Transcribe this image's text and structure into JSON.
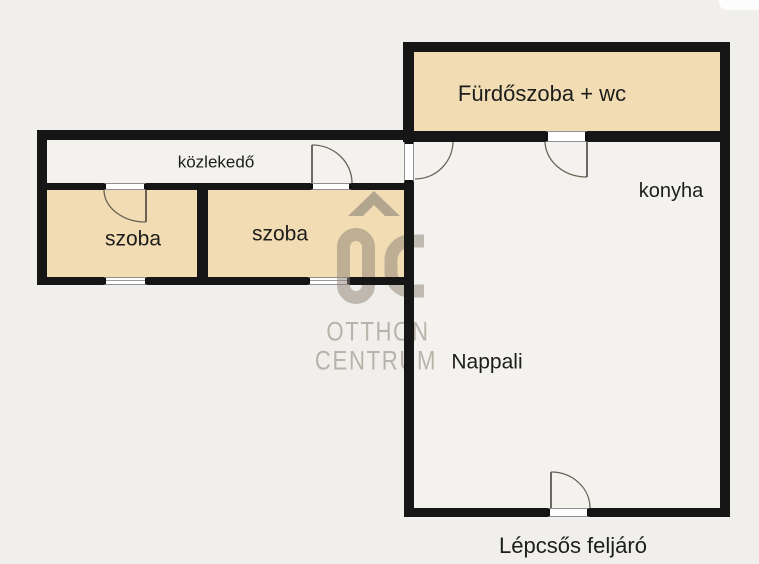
{
  "palette": {
    "background": "#f0efeb",
    "wall": "#161616",
    "room_fill": "#f1dcb4",
    "floor_fill": "#f3f2ee",
    "text": "#1d1d1b",
    "watermark": "#8b8274",
    "door_line": "#6a6257",
    "window_line": "#8f8f8f"
  },
  "labels": {
    "bathroom": "Fürdőszoba + wc",
    "kitchen": "konyha",
    "hallway": "közlekedő",
    "room_left": "szoba",
    "room_right": "szoba",
    "living_room": "Nappali",
    "stairs": "Lépcsős feljáró"
  },
  "watermark": {
    "logo": "OC",
    "brand_line1": "OTTHON",
    "brand_line2": "CENTRUM"
  }
}
